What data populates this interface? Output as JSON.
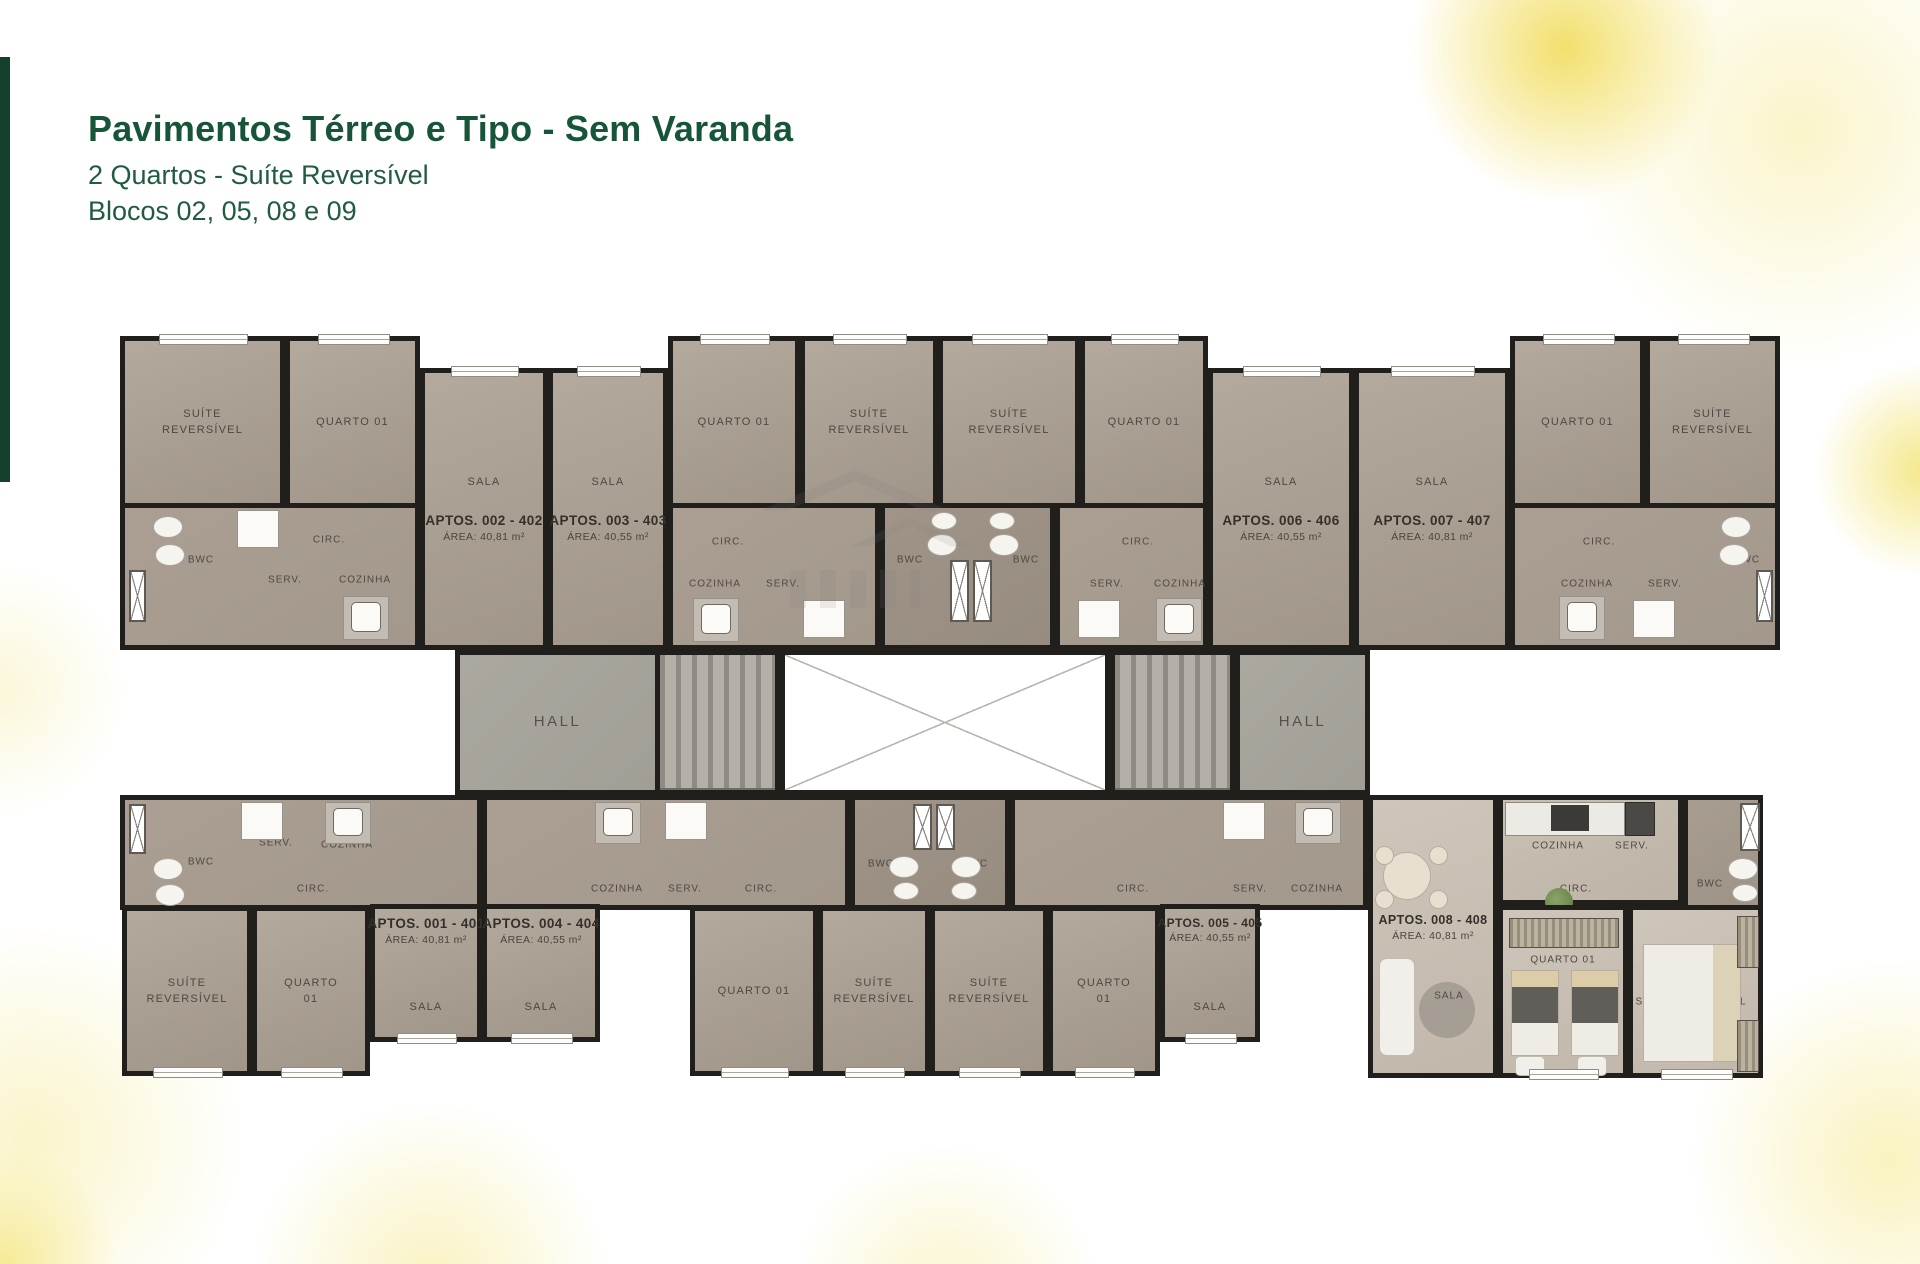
{
  "header": {
    "title": "Pavimentos Térreo e Tipo - Sem Varanda",
    "subtitle": "2 Quartos - Suíte Reversível",
    "blocos": "Blocos 02, 05, 08 e 09"
  },
  "plan": {
    "hall_label": "HALL",
    "labels": {
      "suite": "SUÍTE REVERSÍVEL",
      "quarto": "QUARTO 01",
      "sala": "SALA",
      "circ": "CIRC.",
      "serv": "SERV.",
      "cozinha": "COZINHA",
      "bwc": "BWC"
    },
    "apartments": [
      {
        "name": "APTOS. 002 - 402",
        "area": "ÁREA: 40,81 m²"
      },
      {
        "name": "APTOS. 003 - 403",
        "area": "ÁREA: 40,55 m²"
      },
      {
        "name": "APTOS. 006 - 406",
        "area": "ÁREA: 40,55 m²"
      },
      {
        "name": "APTOS. 007 - 407",
        "area": "ÁREA: 40,81 m²"
      },
      {
        "name": "APTOS. 001 - 401",
        "area": "ÁREA: 40,81 m²"
      },
      {
        "name": "APTOS. 004 - 404",
        "area": "ÁREA: 40,55 m²"
      },
      {
        "name": "APTOS. 005 - 405",
        "area": "ÁREA: 40,55 m²"
      },
      {
        "name": "APTOS. 008 - 408",
        "area": "ÁREA: 40,81 m²"
      }
    ],
    "colors": {
      "title_green": "#175539",
      "accent_bar_green": "#15402b",
      "wall": "#201f1c",
      "floor_taupe": "#aba096",
      "hall_grey": "#a6a39b",
      "highlight_yellow": "#f2de74"
    }
  }
}
